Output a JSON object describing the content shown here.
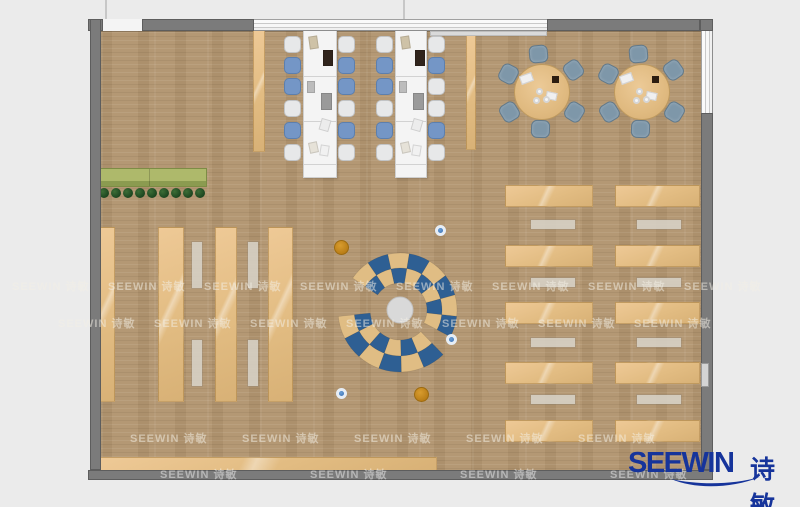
{
  "page": {
    "background": "#ebebeb",
    "description": "Top-down furniture floor plan rendering of a library reading room"
  },
  "logo": {
    "brand": "SEEWIN",
    "chinese": "诗敏",
    "color": "#16349b"
  },
  "watermark": {
    "text": "SEEWIN 诗敏"
  },
  "colors": {
    "floor": "#b2956f",
    "wall": "#7b7b7b",
    "furniture_tan": "#e2bc82",
    "arc_blue": "#2e5f93",
    "arc_tan": "#e0bd84",
    "chair_blue": "#7496c6",
    "chair_white": "#e7e8e9",
    "round_chair_gray_blue": "#7e97a9",
    "stool_blue": "#4a86c8",
    "stool_orange": "#c8891d",
    "planter_green": "#aeb96b",
    "plant_green": "#1a431e"
  },
  "scene": {
    "canvas": {
      "w": 800,
      "h": 507
    },
    "floor": {
      "x": 101,
      "y": 31,
      "w": 600,
      "h": 439
    },
    "planter": {
      "x": 100,
      "y": 168,
      "w": 107,
      "h": 19,
      "split": 48
    },
    "plants": {
      "cy": 193,
      "x0": 104,
      "step": 12,
      "count": 9,
      "r": 5
    },
    "shelves": {
      "y": 227,
      "h": 175,
      "cols": [
        {
          "x": 96,
          "w": 19
        },
        {
          "x": 158,
          "w": 26
        },
        {
          "x": 215,
          "w": 22
        },
        {
          "x": 268,
          "w": 25
        }
      ]
    },
    "shelf_benches": {
      "xs": [
        192,
        248
      ],
      "w": 10,
      "segs": [
        [
          242,
          46
        ],
        [
          340,
          46
        ]
      ]
    },
    "side_strips": [
      {
        "x": 253,
        "y": 30,
        "w": 12,
        "h": 122
      },
      {
        "x": 466,
        "y": 35,
        "w": 10,
        "h": 115
      }
    ],
    "bottom_bench": {
      "x": 100,
      "y": 457,
      "w": 337,
      "h": 14
    },
    "long_tables": {
      "y": 30,
      "h": 148,
      "dividers": [
        45,
        90,
        133
      ],
      "tables": [
        {
          "x": 303,
          "w": 34
        },
        {
          "x": 395,
          "w": 32
        }
      ]
    },
    "table_chairs": {
      "ys": [
        36,
        57,
        78,
        100,
        122,
        144
      ],
      "w": 17,
      "h": 17,
      "cols": [
        {
          "x": 284,
          "pattern": [
            "w",
            "b",
            "b",
            "w",
            "b",
            "w"
          ]
        },
        {
          "x": 338,
          "pattern": [
            "w",
            "b",
            "b",
            "w",
            "b",
            "w"
          ]
        },
        {
          "x": 376,
          "pattern": [
            "w",
            "b",
            "b",
            "w",
            "b",
            "w"
          ]
        },
        {
          "x": 428,
          "pattern": [
            "w",
            "b",
            "w",
            "w",
            "b",
            "w"
          ]
        }
      ]
    },
    "table_items": [
      {
        "x": 5,
        "y": 5,
        "w": 9,
        "h": 13,
        "c": "#cec2a7",
        "r": -8
      },
      {
        "x": 19,
        "y": 19,
        "w": 10,
        "h": 16,
        "c": "#30241c",
        "r": 0
      },
      {
        "x": 3,
        "y": 50,
        "w": 8,
        "h": 12,
        "c": "#bcbcbc",
        "r": 0
      },
      {
        "x": 17,
        "y": 62,
        "w": 11,
        "h": 17,
        "c": "#9a9a9a",
        "r": 0
      },
      {
        "x": 16,
        "y": 88,
        "w": 10,
        "h": 12,
        "c": "#ececec",
        "r": 16
      },
      {
        "x": 5,
        "y": 111,
        "w": 9,
        "h": 11,
        "c": "#e6e2d8",
        "r": -12
      },
      {
        "x": 16,
        "y": 114,
        "w": 9,
        "h": 11,
        "c": "#f1f1f1",
        "r": 9
      }
    ],
    "round_tables": {
      "r": 28,
      "chair_dist": 38,
      "chair_size": 19,
      "angles": [
        95,
        152,
        212,
        268,
        328,
        35
      ],
      "centers": [
        [
          542,
          92
        ],
        [
          642,
          92
        ]
      ]
    },
    "desks": {
      "rows": [
        185,
        245,
        302,
        362,
        420
      ],
      "h": 22,
      "cols": [
        {
          "x": 505,
          "w": 88
        },
        {
          "x": 615,
          "w": 85
        }
      ],
      "benches": {
        "rows": [
          220,
          278,
          338,
          395
        ],
        "h": 9,
        "cols": [
          {
            "x": 531,
            "w": 44
          },
          {
            "x": 637,
            "w": 44
          }
        ]
      }
    },
    "arcs": {
      "cx": 400,
      "cy": 310,
      "tan": "#e0bd84",
      "blue": "#2e5f93",
      "hub_r": 13,
      "hub_c": "#d9d9d9",
      "groups": [
        {
          "a0": -28,
          "a1": 146,
          "n": 8,
          "rings": [
            [
              27,
              42
            ],
            [
              42,
              57
            ]
          ],
          "phase": 0
        },
        {
          "a0": 186,
          "a1": 314,
          "n": 6,
          "rings": [
            [
              30,
              46
            ],
            [
              46,
              62
            ]
          ],
          "phase": 1
        }
      ]
    },
    "stools": {
      "blue": [
        [
          443,
          233
        ],
        [
          454,
          342
        ],
        [
          344,
          396
        ]
      ],
      "orange": [
        [
          342,
          248
        ],
        [
          422,
          395
        ]
      ]
    },
    "walls": [
      [
        88,
        19,
        15,
        12
      ],
      [
        142,
        19,
        112,
        12
      ],
      [
        547,
        19,
        153,
        12
      ],
      [
        700,
        19,
        13,
        12
      ],
      [
        90,
        19,
        11,
        451
      ],
      [
        701,
        113,
        12,
        357
      ],
      [
        88,
        470,
        625,
        10
      ]
    ],
    "window_top": {
      "x": 254,
      "y": 19,
      "w": 293,
      "h": 12
    },
    "window_right": {
      "x": 701,
      "y": 31,
      "w": 12,
      "h": 82
    },
    "door_gap": {
      "x": 103,
      "y": 19,
      "w": 39,
      "h": 12
    },
    "door_patch": {
      "x": 701,
      "y": 363,
      "w": 8,
      "h": 24
    },
    "stubs": [
      [
        105,
        0,
        2,
        19
      ],
      [
        403,
        0,
        2,
        19
      ]
    ],
    "sill": {
      "x": 430,
      "y": 31,
      "w": 117,
      "h": 5
    },
    "watermark_rows": [
      {
        "y": 278,
        "x0": 12,
        "dx": 96,
        "n": 8
      },
      {
        "y": 315,
        "x0": 58,
        "dx": 96,
        "n": 7
      },
      {
        "y": 430,
        "x0": 130,
        "dx": 112,
        "n": 5
      },
      {
        "y": 466,
        "x0": 160,
        "dx": 150,
        "n": 4
      }
    ]
  }
}
